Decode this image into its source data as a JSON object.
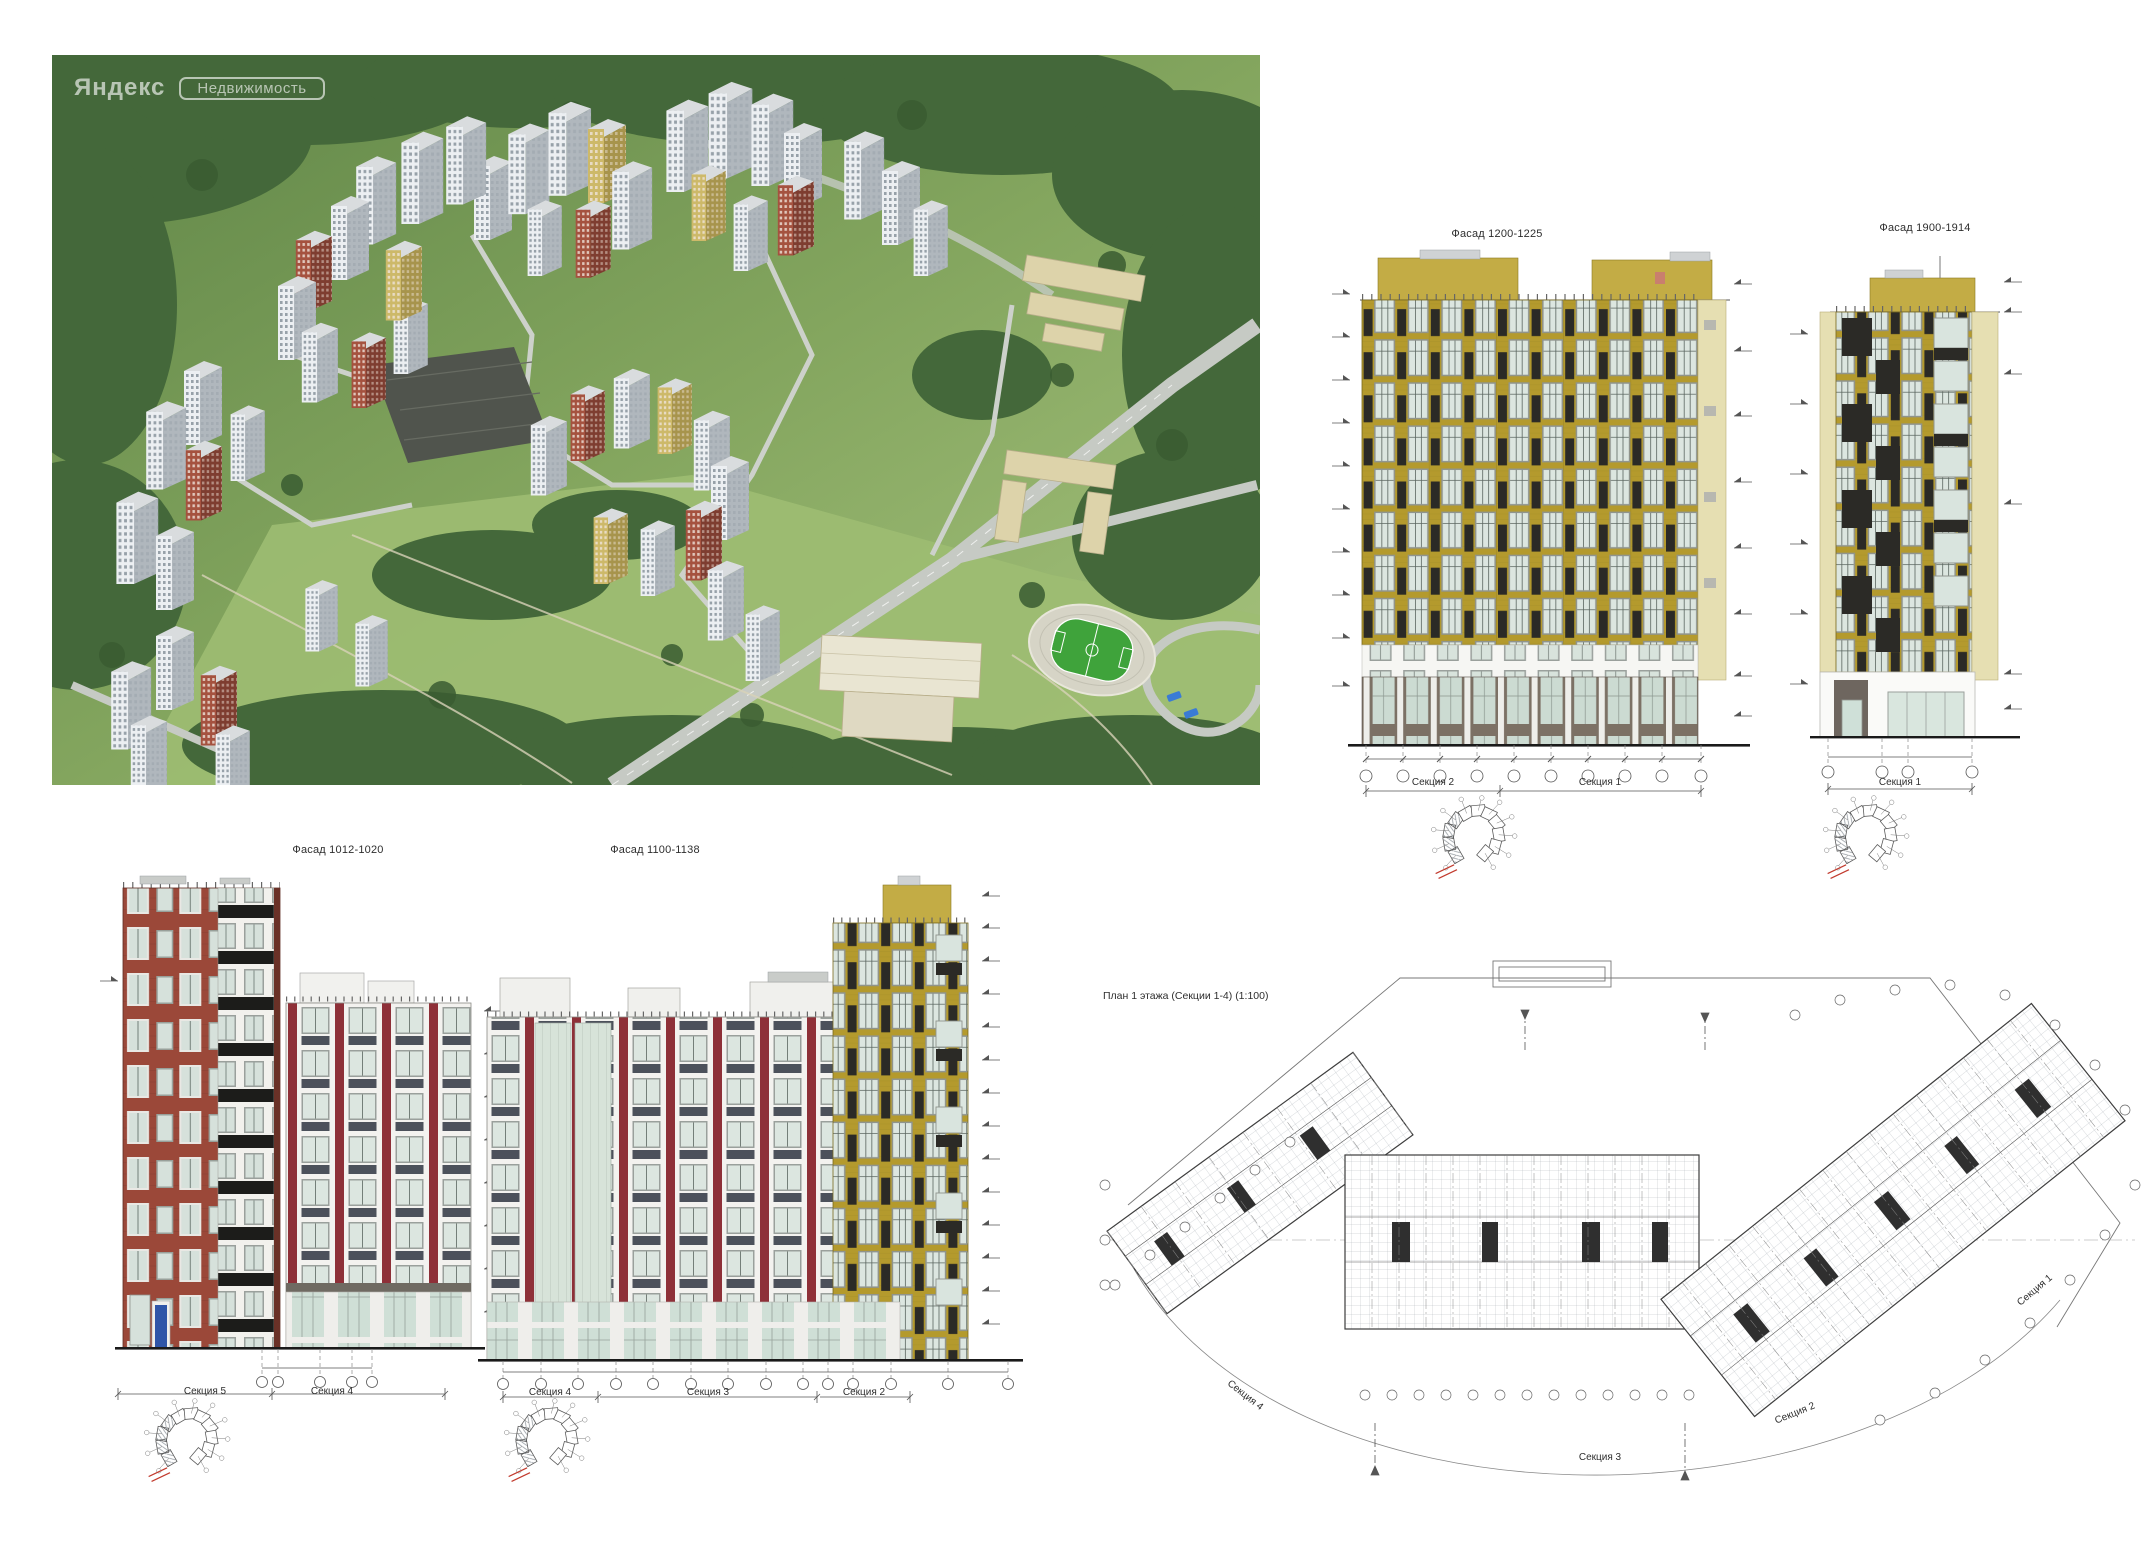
{
  "aerial": {
    "watermark_brand": "Яндекс",
    "watermark_product": "Недвижимость"
  },
  "facade_1200_1225": {
    "title": "Фасад 1200-1225",
    "section_labels": [
      "Секция 2",
      "Секция 1"
    ]
  },
  "facade_1900_1914": {
    "title": "Фасад 1900-1914",
    "section_labels": [
      "Секция 1"
    ]
  },
  "facade_1012_1020": {
    "title": "Фасад 1012-1020",
    "section_labels": [
      "Секция 5",
      "Секция 4"
    ]
  },
  "facade_1100_1138": {
    "title": "Фасад 1100-1138",
    "section_labels": [
      "Секция 4",
      "Секция 3",
      "Секция 2"
    ]
  },
  "floor_plan": {
    "title": "План 1 этажа (Секции 1-4) (1:100)",
    "section_labels": [
      "Секция 4",
      "Секция 3",
      "Секция 2",
      "Секция 1"
    ]
  },
  "colors": {
    "facade_yellow": "#b49a2d",
    "facade_yellow_light": "#e6dfb2",
    "facade_red": "#9b4839",
    "frame_maroon": "#8e3038",
    "panel_dark": "#2b2a26",
    "glass": "#dce6e0",
    "ground_taupe": "#7c7165",
    "spandrel_slate": "#4c515b",
    "door_blue": "#2f55a8",
    "field_green": "#3fa33b",
    "keyplan_red": "#c23b2e"
  }
}
